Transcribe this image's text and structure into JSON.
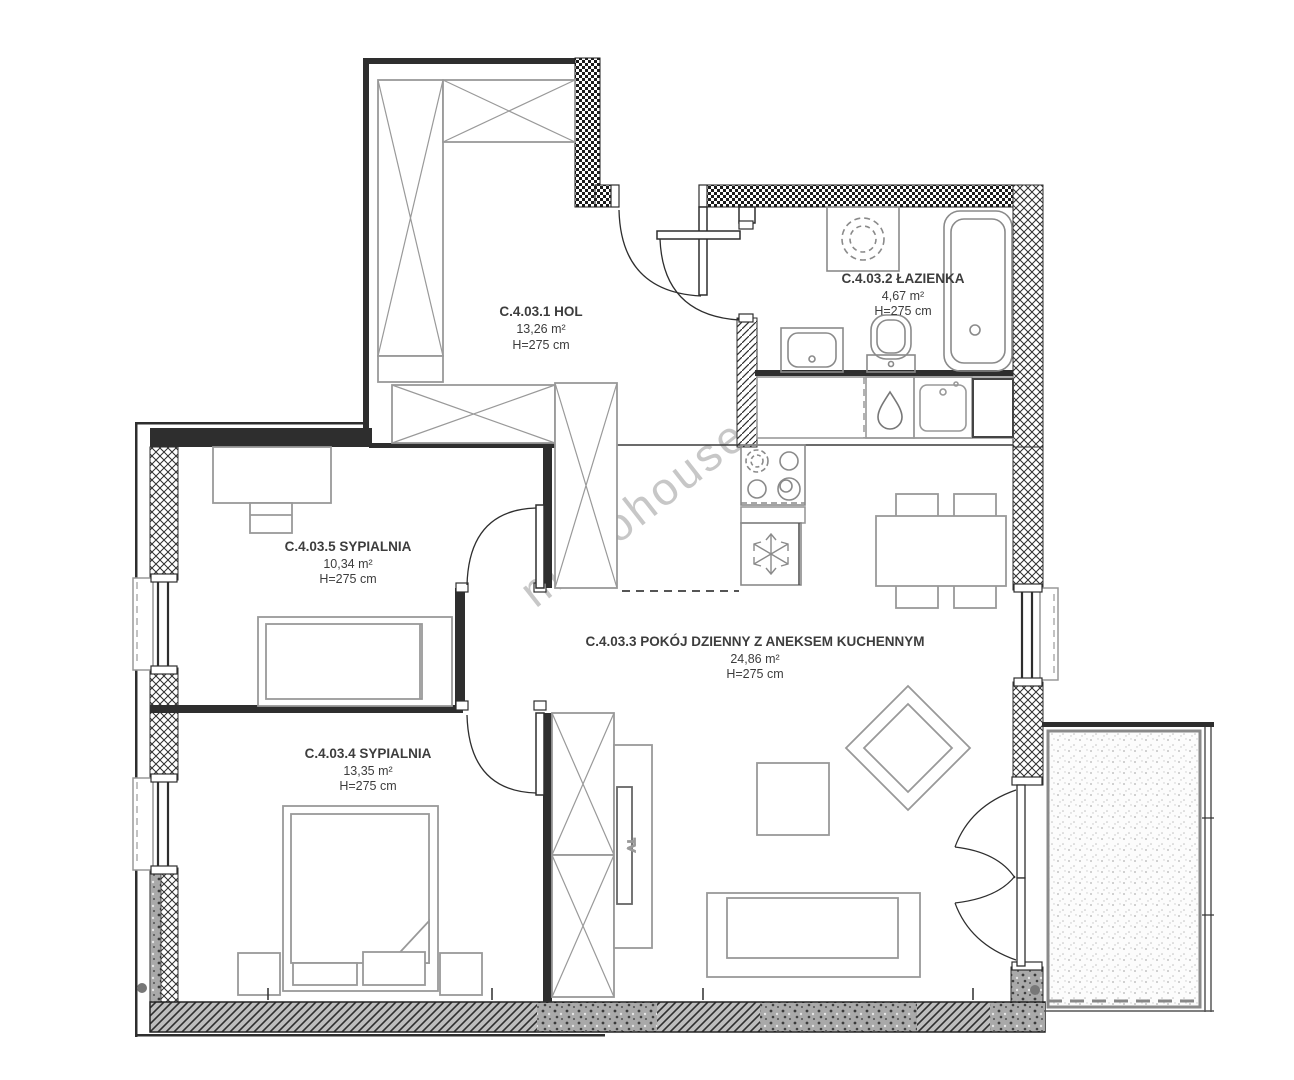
{
  "watermark": "metrohouse",
  "rooms": [
    {
      "label": "C.4.03.1 HOL",
      "area": "13,26 m²",
      "height": "H=275 cm"
    },
    {
      "label": "C.4.03.2 ŁAZIENKA",
      "area": "4,67 m²",
      "height": "H=275 cm"
    },
    {
      "label": "C.4.03.3 POKÓJ DZIENNY Z ANEKSEM KUCHENNYM",
      "area": "24,86 m²",
      "height": "H=275 cm"
    },
    {
      "label": "C.4.03.4 SYPIALNIA",
      "area": "13,35 m²",
      "height": "H=275 cm"
    },
    {
      "label": "C.4.03.5 SYPIALNIA",
      "area": "10,34 m²",
      "height": "H=275 cm"
    }
  ],
  "labels": {
    "tv": "TV"
  },
  "colors": {
    "wall": "#2e2e2e",
    "furniture": "#999999",
    "fixture": "#8a8a8a",
    "text": "#3d3d3d",
    "watermark": "#c7c7c7"
  }
}
